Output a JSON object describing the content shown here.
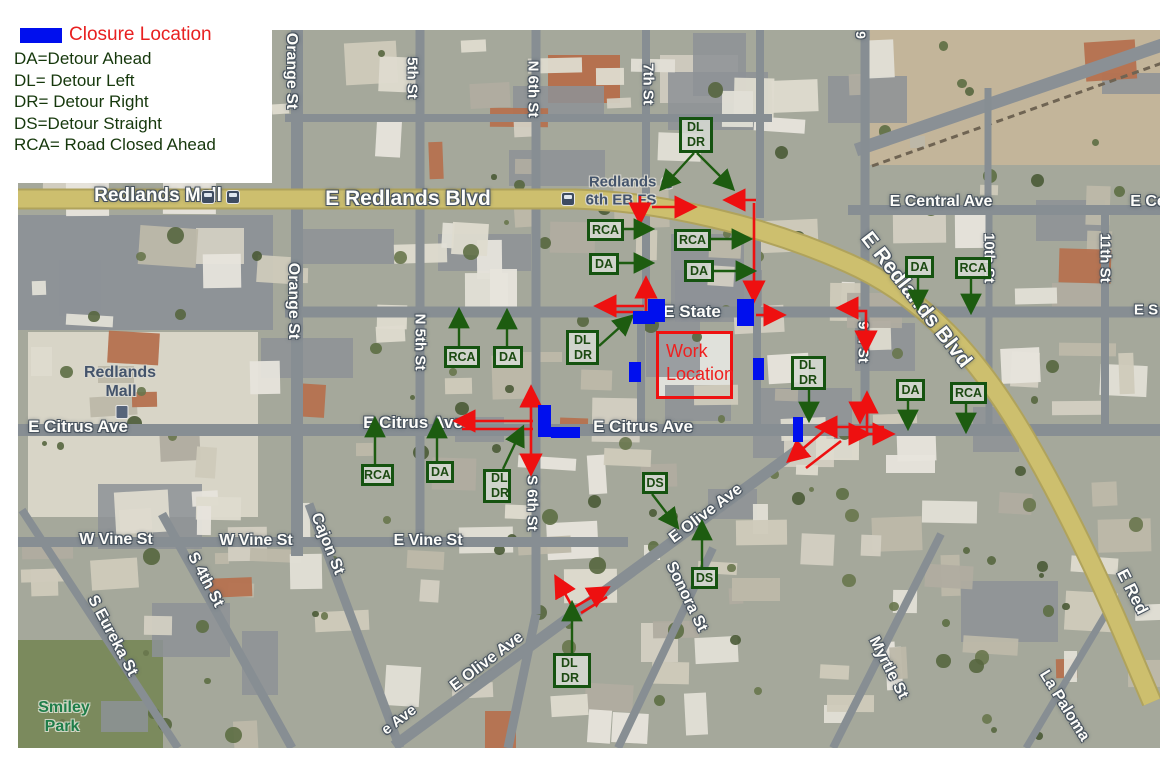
{
  "title": "Road closure and detour map - Redlands",
  "legend": {
    "closure_label": "Closure Location",
    "items": [
      {
        "text": "DA=Detour Ahead"
      },
      {
        "text": "DL= Detour Left"
      },
      {
        "text": "DR= Detour Right"
      },
      {
        "text": "DS=Detour Straight"
      },
      {
        "text": "RCA= Road Closed Ahead"
      }
    ]
  },
  "colors": {
    "closure_blue": "#000fee",
    "detour_route_red": "#ee1010",
    "sign_green": "#155310",
    "road_yellow": "#cdbf6e",
    "legend_title_red": "#e82020",
    "legend_text_green": "#16380c"
  },
  "work_location": {
    "label_line1": "Work",
    "label_line2": "Location",
    "x": 656,
    "y": 331,
    "w": 77,
    "h": 68
  },
  "closures": [
    {
      "x": 648,
      "y": 299,
      "w": 17,
      "h": 23
    },
    {
      "x": 633,
      "y": 311,
      "w": 22,
      "h": 13
    },
    {
      "x": 737,
      "y": 299,
      "w": 17,
      "h": 27
    },
    {
      "x": 629,
      "y": 362,
      "w": 12,
      "h": 20
    },
    {
      "x": 753,
      "y": 358,
      "w": 11,
      "h": 22
    },
    {
      "x": 793,
      "y": 417,
      "w": 10,
      "h": 25
    },
    {
      "x": 538,
      "y": 405,
      "w": 13,
      "h": 32
    },
    {
      "x": 551,
      "y": 427,
      "w": 29,
      "h": 11
    }
  ],
  "signs": [
    {
      "lines": [
        "DL",
        "DR"
      ],
      "x": 679,
      "y": 117,
      "w": 34,
      "h": 36,
      "arrows": [
        [
          [
            694,
            153
          ],
          [
            664,
            186
          ]
        ],
        [
          [
            697,
            153
          ],
          [
            730,
            186
          ]
        ]
      ]
    },
    {
      "lines": [
        "RCA"
      ],
      "x": 587,
      "y": 219,
      "w": 37,
      "h": 22,
      "arrows": [
        [
          [
            624,
            229
          ],
          [
            648,
            229
          ]
        ]
      ]
    },
    {
      "lines": [
        "RCA"
      ],
      "x": 674,
      "y": 229,
      "w": 37,
      "h": 22,
      "arrows": [
        [
          [
            711,
            239
          ],
          [
            746,
            239
          ]
        ]
      ]
    },
    {
      "lines": [
        "DA"
      ],
      "x": 589,
      "y": 253,
      "w": 30,
      "h": 22,
      "arrows": [
        [
          [
            619,
            263
          ],
          [
            648,
            263
          ]
        ]
      ]
    },
    {
      "lines": [
        "DA"
      ],
      "x": 684,
      "y": 260,
      "w": 30,
      "h": 22,
      "arrows": [
        [
          [
            714,
            271
          ],
          [
            750,
            271
          ]
        ]
      ]
    },
    {
      "lines": [
        "DA"
      ],
      "x": 905,
      "y": 256,
      "w": 29,
      "h": 22,
      "arrows": [
        [
          [
            918,
            278
          ],
          [
            918,
            304
          ]
        ]
      ]
    },
    {
      "lines": [
        "RCA"
      ],
      "x": 955,
      "y": 257,
      "w": 36,
      "h": 22,
      "arrows": [
        [
          [
            971,
            279
          ],
          [
            971,
            308
          ]
        ]
      ]
    },
    {
      "lines": [
        "DA"
      ],
      "x": 896,
      "y": 379,
      "w": 29,
      "h": 22,
      "arrows": [
        [
          [
            908,
            401
          ],
          [
            908,
            424
          ]
        ]
      ]
    },
    {
      "lines": [
        "RCA"
      ],
      "x": 950,
      "y": 382,
      "w": 37,
      "h": 22,
      "arrows": [
        [
          [
            966,
            404
          ],
          [
            966,
            427
          ]
        ]
      ]
    },
    {
      "lines": [
        "RCA"
      ],
      "x": 444,
      "y": 346,
      "w": 36,
      "h": 22,
      "arrows": [
        [
          [
            459,
            346
          ],
          [
            459,
            314
          ]
        ]
      ]
    },
    {
      "lines": [
        "DA"
      ],
      "x": 493,
      "y": 346,
      "w": 30,
      "h": 22,
      "arrows": [
        [
          [
            507,
            346
          ],
          [
            507,
            315
          ]
        ]
      ]
    },
    {
      "lines": [
        "DL",
        "DR"
      ],
      "x": 566,
      "y": 330,
      "w": 33,
      "h": 35,
      "arrows": [
        [
          [
            599,
            346
          ],
          [
            629,
            319
          ]
        ]
      ]
    },
    {
      "lines": [
        "DL",
        "DR"
      ],
      "x": 791,
      "y": 356,
      "w": 35,
      "h": 34,
      "arrows": [
        [
          [
            809,
            390
          ],
          [
            809,
            416
          ]
        ]
      ]
    },
    {
      "lines": [
        "RCA"
      ],
      "x": 361,
      "y": 464,
      "w": 33,
      "h": 22,
      "arrows": [
        [
          [
            375,
            464
          ],
          [
            375,
            423
          ]
        ]
      ]
    },
    {
      "lines": [
        "DA"
      ],
      "x": 426,
      "y": 461,
      "w": 28,
      "h": 22,
      "arrows": [
        [
          [
            437,
            461
          ],
          [
            437,
            424
          ]
        ]
      ]
    },
    {
      "lines": [
        "DL",
        "DR"
      ],
      "x": 483,
      "y": 469,
      "w": 28,
      "h": 34,
      "arrows": [
        [
          [
            503,
            469
          ],
          [
            521,
            431
          ]
        ]
      ]
    },
    {
      "lines": [
        "DS"
      ],
      "x": 642,
      "y": 472,
      "w": 26,
      "h": 22,
      "arrows": [
        [
          [
            652,
            494
          ],
          [
            675,
            524
          ]
        ]
      ]
    },
    {
      "lines": [
        "DS"
      ],
      "x": 691,
      "y": 567,
      "w": 27,
      "h": 22,
      "arrows": [
        [
          [
            702,
            567
          ],
          [
            702,
            526
          ]
        ]
      ]
    },
    {
      "lines": [
        "DL",
        "DR"
      ],
      "x": 553,
      "y": 653,
      "w": 38,
      "h": 35,
      "arrows": [
        [
          [
            572,
            653
          ],
          [
            572,
            607
          ]
        ]
      ]
    }
  ],
  "detour_arrows": [
    {
      "points": [
        [
          640,
          196
        ],
        [
          640,
          218
        ]
      ]
    },
    {
      "points": [
        [
          652,
          207
        ],
        [
          690,
          207
        ]
      ]
    },
    {
      "points": [
        [
          756,
          200
        ],
        [
          730,
          200
        ]
      ]
    },
    {
      "points": [
        [
          754,
          203
        ],
        [
          754,
          296
        ]
      ]
    },
    {
      "points": [
        [
          646,
          313
        ],
        [
          646,
          283
        ]
      ]
    },
    {
      "points": [
        [
          644,
          306
        ],
        [
          601,
          306
        ]
      ]
    },
    {
      "points": [
        [
          612,
          312
        ],
        [
          643,
          312
        ]
      ],
      "plain": true
    },
    {
      "points": [
        [
          756,
          315
        ],
        [
          779,
          315
        ]
      ]
    },
    {
      "points": [
        [
          846,
          311
        ],
        [
          866,
          311
        ],
        [
          866,
          346
        ]
      ]
    },
    {
      "points": [
        [
          858,
          308
        ],
        [
          843,
          308
        ]
      ]
    },
    {
      "points": [
        [
          867,
          432
        ],
        [
          867,
          398
        ]
      ]
    },
    {
      "points": [
        [
          884,
          427
        ],
        [
          822,
          427
        ]
      ]
    },
    {
      "points": [
        [
          852,
          434
        ],
        [
          864,
          434
        ]
      ]
    },
    {
      "points": [
        [
          868,
          434
        ],
        [
          888,
          434
        ]
      ]
    },
    {
      "points": [
        [
          860,
          404
        ],
        [
          860,
          417
        ]
      ]
    },
    {
      "points": [
        [
          826,
          429
        ],
        [
          792,
          458
        ]
      ]
    },
    {
      "points": [
        [
          841,
          441
        ],
        [
          806,
          468
        ]
      ],
      "plain": true
    },
    {
      "points": [
        [
          531,
          430
        ],
        [
          531,
          392
        ]
      ]
    },
    {
      "points": [
        [
          531,
          430
        ],
        [
          531,
          469
        ]
      ]
    },
    {
      "points": [
        [
          533,
          421
        ],
        [
          460,
          421
        ]
      ]
    },
    {
      "points": [
        [
          462,
          429
        ],
        [
          533,
          429
        ]
      ],
      "plain": true
    },
    {
      "points": [
        [
          573,
          608
        ],
        [
          558,
          581
        ]
      ]
    },
    {
      "points": [
        [
          573,
          608
        ],
        [
          604,
          590
        ]
      ]
    },
    {
      "points": [
        [
          581,
          613
        ],
        [
          607,
          597
        ]
      ],
      "plain": true
    }
  ],
  "street_labels": [
    {
      "text": "E Redlands Blvd",
      "x": 408,
      "y": 199,
      "rot": 0,
      "size": 21,
      "style": "major"
    },
    {
      "text": "Redlands Mall",
      "x": 158,
      "y": 196,
      "rot": 0,
      "size": 19,
      "style": "major"
    },
    {
      "text": "E Central Ave",
      "x": 941,
      "y": 202,
      "rot": 0,
      "size": 16,
      "style": "major"
    },
    {
      "text": "E Ce",
      "x": 1148,
      "y": 202,
      "rot": 0,
      "size": 16,
      "style": "major"
    },
    {
      "text": "E Redlands Blvd",
      "x": 916,
      "y": 300,
      "rot": 52,
      "size": 21,
      "style": "major"
    },
    {
      "text": "E State",
      "x": 692,
      "y": 312,
      "rot": 0,
      "size": 17,
      "style": "major"
    },
    {
      "text": "E S",
      "x": 1146,
      "y": 310,
      "rot": 0,
      "size": 15,
      "style": "major"
    },
    {
      "text": "E Citrus Ave",
      "x": 78,
      "y": 427,
      "rot": 0,
      "size": 17,
      "style": "major"
    },
    {
      "text": "E Citrus Ave",
      "x": 413,
      "y": 423,
      "rot": 0,
      "size": 17,
      "style": "major"
    },
    {
      "text": "E Citrus Ave",
      "x": 643,
      "y": 427,
      "rot": 0,
      "size": 17,
      "style": "major"
    },
    {
      "text": "W Vine St",
      "x": 116,
      "y": 540,
      "rot": 0,
      "size": 16,
      "style": "major"
    },
    {
      "text": "W Vine St",
      "x": 256,
      "y": 541,
      "rot": 0,
      "size": 16,
      "style": "major"
    },
    {
      "text": "E Vine St",
      "x": 428,
      "y": 541,
      "rot": 0,
      "size": 16,
      "style": "major"
    },
    {
      "text": "E Olive Ave",
      "x": 706,
      "y": 514,
      "rot": -37,
      "size": 16,
      "style": "major"
    },
    {
      "text": "E Olive Ave",
      "x": 487,
      "y": 662,
      "rot": -37,
      "size": 16,
      "style": "major"
    },
    {
      "text": "e Ave",
      "x": 399,
      "y": 720,
      "rot": -37,
      "size": 15,
      "style": "major"
    },
    {
      "text": "Orange St",
      "x": 291,
      "y": 71,
      "rot": 90,
      "size": 16,
      "style": "major"
    },
    {
      "text": "Orange St",
      "x": 293,
      "y": 301,
      "rot": 90,
      "size": 16,
      "style": "major"
    },
    {
      "text": "5th St",
      "x": 412,
      "y": 78,
      "rot": 90,
      "size": 15,
      "style": "major"
    },
    {
      "text": "N 5th St",
      "x": 420,
      "y": 342,
      "rot": 90,
      "size": 15,
      "style": "major"
    },
    {
      "text": "N 6th St",
      "x": 533,
      "y": 89,
      "rot": 90,
      "size": 15,
      "style": "major"
    },
    {
      "text": "S 6th St",
      "x": 532,
      "y": 503,
      "rot": 90,
      "size": 15,
      "style": "major"
    },
    {
      "text": "7th St",
      "x": 648,
      "y": 84,
      "rot": 90,
      "size": 15,
      "style": "major"
    },
    {
      "text": "9",
      "x": 861,
      "y": 35,
      "rot": 90,
      "size": 14,
      "style": "major"
    },
    {
      "text": "9th St",
      "x": 863,
      "y": 342,
      "rot": 90,
      "size": 15,
      "style": "major"
    },
    {
      "text": "10th St",
      "x": 989,
      "y": 258,
      "rot": 90,
      "size": 15,
      "style": "major"
    },
    {
      "text": "11th St",
      "x": 1105,
      "y": 258,
      "rot": 90,
      "size": 15,
      "style": "major"
    },
    {
      "text": "Sonora St",
      "x": 686,
      "y": 597,
      "rot": 64,
      "size": 16,
      "style": "major"
    },
    {
      "text": "Myrtle St",
      "x": 888,
      "y": 668,
      "rot": 63,
      "size": 16,
      "style": "major"
    },
    {
      "text": "La Paloma",
      "x": 1064,
      "y": 706,
      "rot": 58,
      "size": 16,
      "style": "major"
    },
    {
      "text": "Cajon St",
      "x": 327,
      "y": 544,
      "rot": 68,
      "size": 16,
      "style": "major"
    },
    {
      "text": "S 4th St",
      "x": 205,
      "y": 580,
      "rot": 62,
      "size": 16,
      "style": "major"
    },
    {
      "text": "S Eureka St",
      "x": 112,
      "y": 636,
      "rot": 62,
      "size": 16,
      "style": "major"
    },
    {
      "text": "E Red",
      "x": 1132,
      "y": 592,
      "rot": 63,
      "size": 17,
      "style": "major"
    },
    {
      "text": "Redlands",
      "x": 120,
      "y": 373,
      "rot": 0,
      "size": 16,
      "style": "place"
    },
    {
      "text": "Mall",
      "x": 121,
      "y": 392,
      "rot": 0,
      "size": 16,
      "style": "place"
    },
    {
      "text": "Redlands @",
      "x": 632,
      "y": 182,
      "rot": 0,
      "size": 15,
      "style": "place"
    },
    {
      "text": "6th EB FS",
      "x": 621,
      "y": 200,
      "rot": 0,
      "size": 15,
      "style": "place"
    },
    {
      "text": "Smiley",
      "x": 64,
      "y": 708,
      "rot": 0,
      "size": 16,
      "style": "park"
    },
    {
      "text": "Park",
      "x": 62,
      "y": 727,
      "rot": 0,
      "size": 16,
      "style": "park"
    }
  ],
  "icons": [
    {
      "type": "bus-stop",
      "x": 208,
      "y": 197
    },
    {
      "type": "bus-stop",
      "x": 233,
      "y": 197
    },
    {
      "type": "bus-stop",
      "x": 568,
      "y": 199
    },
    {
      "type": "shopping-bag",
      "x": 122,
      "y": 412
    }
  ]
}
